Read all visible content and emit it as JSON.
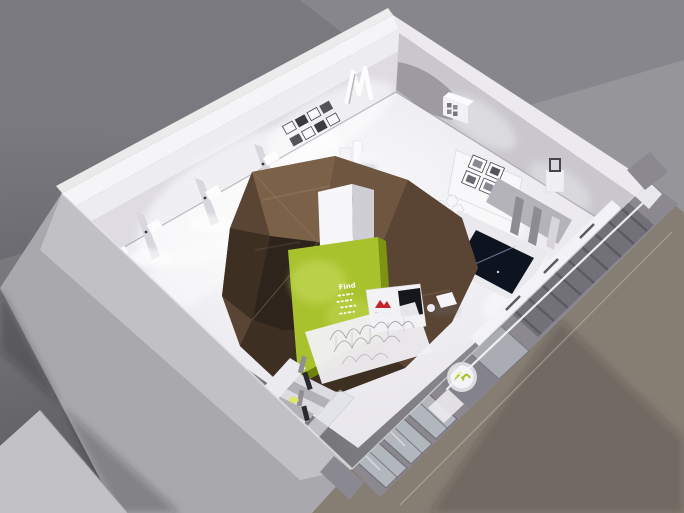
{
  "scene": {
    "green_panel_word": "Find"
  },
  "palette": {
    "background": "#8b8a8f",
    "background_shadow": "#58575c",
    "sidewalk": "#867d73",
    "sidewalk_far": "#6b645b",
    "platform": "#c2c1c5",
    "platform_light": "#d2d2d5",
    "wall_top": "#f5f4f7",
    "wall_nw_face": "#dedce2",
    "wall_ne_face": "#c9c7cd",
    "wall_sw_exterior": "#a9a8ad",
    "facade": "#8b898f",
    "facade_pillar": "#84828a",
    "glass": "#c3cad1",
    "mullion": "#696871",
    "floor": "#e6e4ea",
    "wood_light": "#7c6149",
    "wood_warm": "#6e5641",
    "wood_mid": "#5a4534",
    "wood_dark": "#3e2f23",
    "wood_deep": "#2f241b",
    "column": "#f7f6f9",
    "column_shade": "#cfced5",
    "green_panel": "#a8c22d",
    "green_highlight": "#c9dd60",
    "green_edge": "#7d9412",
    "red_logo": "#c2272d",
    "screen": "#0e1320",
    "accent_yellow": "#dce94e",
    "white_fixture": "#f2f1f5",
    "partition": "#d7d5db",
    "frame_dark": "#46454b",
    "scribble": "#94929b",
    "step": "#dcdbe0",
    "step_shadow": "#a3a1a8",
    "stair_dark": "#3f3e44"
  }
}
